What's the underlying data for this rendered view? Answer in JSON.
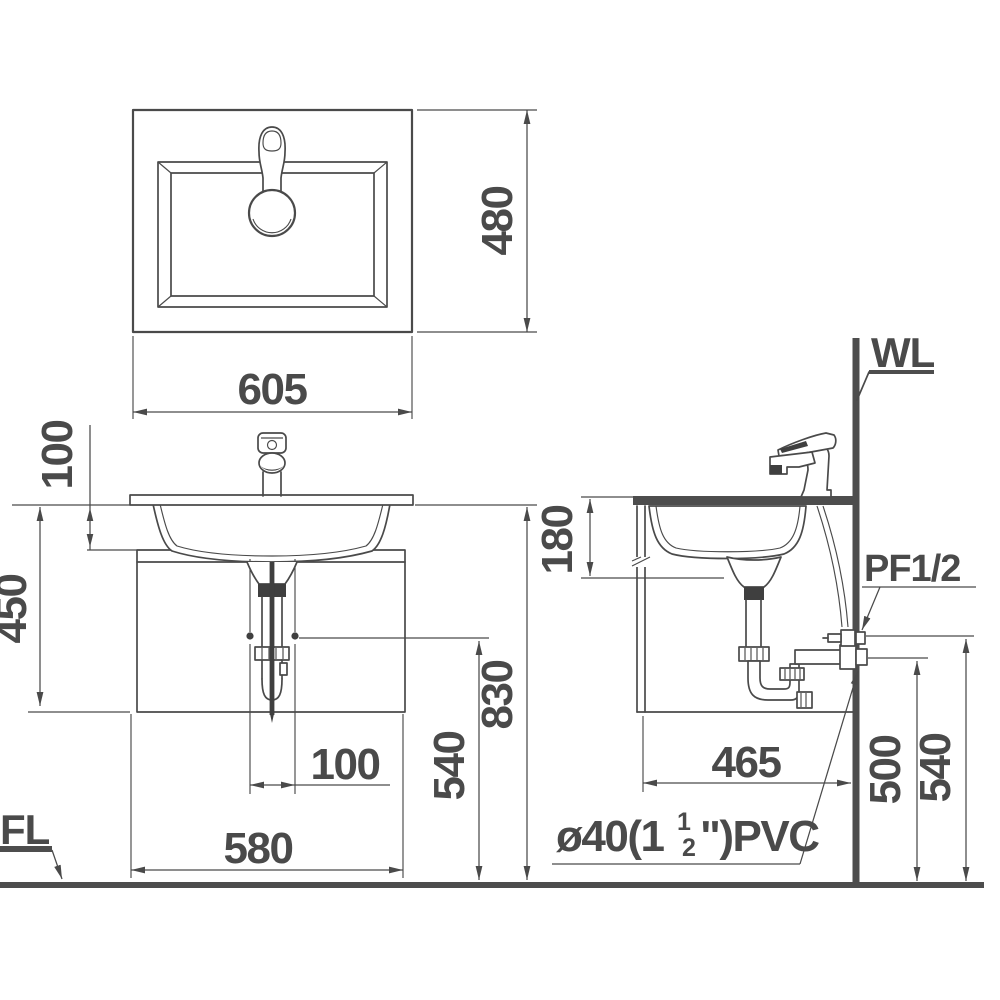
{
  "drawing": {
    "type": "bathroom vanity cabinet installation drawing",
    "views": [
      "top plan",
      "front elevation",
      "side section"
    ]
  },
  "dims": {
    "top_width": "605",
    "top_depth": "480",
    "faucet_offset": "100",
    "cabinet_height": "450",
    "drain_offset": "100",
    "cabinet_width": "580",
    "valve_height_front": "540",
    "counter_height": "830",
    "basin_depth": "180",
    "cabinet_depth": "465",
    "outlet_height": "500",
    "supply_height": "540"
  },
  "labels": {
    "wall": "WL",
    "floor": "FL",
    "supply_fitting": "PF1/2",
    "drain_pipe": {
      "prefix": "ø40(1",
      "numerator": "1",
      "denominator": "2",
      "suffix": "\")PVC"
    }
  },
  "colors": {
    "line": "#4a4a4a",
    "heavy_line": "#4d4d4d",
    "background": "#ffffff"
  }
}
